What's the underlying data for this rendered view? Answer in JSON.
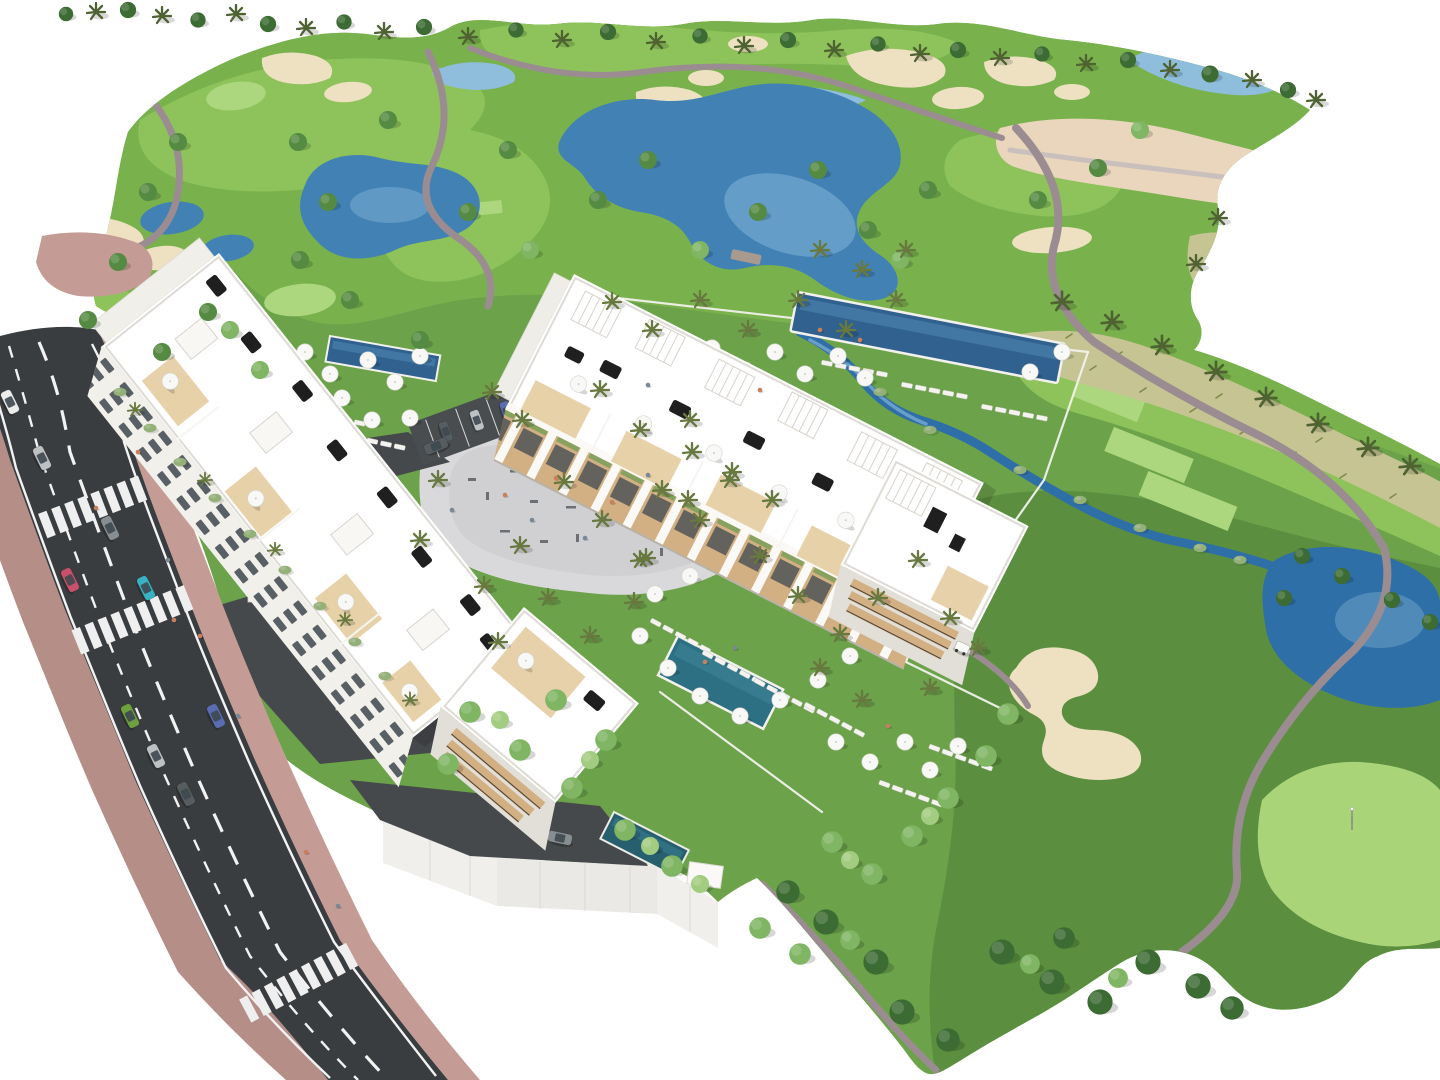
{
  "canvas": {
    "width": 1440,
    "height": 1080
  },
  "scene": {
    "kind": "aerial-3d-architectural-rendering",
    "regions": [
      "golf-course",
      "lakes",
      "sand-bunkers",
      "cart-paths",
      "apartment-buildings",
      "resort-gardens",
      "swimming-pools",
      "playground-plaza",
      "street",
      "parked-cars"
    ]
  },
  "palette": {
    "bg": "#FFFFFF",
    "base": "#6CA24A",
    "fairway": "#79B24D",
    "fairwayLight": "#8DC35A",
    "fairwayPale": "#ACD77E",
    "greenLight": "#A9D478",
    "lawnDark": "#5B8F3F",
    "dryGrass": "#C6C492",
    "sand": "#EDE1C1",
    "sandWaste": "#E9D6BC",
    "water": "#4281B4",
    "waterDeep": "#2F6FA7",
    "waterLight": "#8FBEDD",
    "poolBlue": "#30618F",
    "pool": "#2D7083",
    "road": "#3A3D3F",
    "roadLine": "#F2F2F2",
    "sidewalk": "#C59C95",
    "sidewalkShade": "#B58E88",
    "path": "#9A8C90",
    "pathLight": "#C9BFBC",
    "plaza": "#D9D9DB",
    "plazaEdge": "#C9C9CC",
    "white": "#FFFFFF",
    "facade": "#F2F0EB",
    "facadeShade": "#E2DFD8",
    "wood": "#D2B083",
    "glass": "#3E4850",
    "black": "#1F1F1F",
    "umbrella": "#F8F8F6",
    "tree": "#558A42",
    "treeDark": "#3C6B33",
    "treeLight": "#7FB563",
    "treeLighter": "#A2CC80",
    "palm": "#68793F",
    "palmDark": "#4F6232",
    "shrub": "#93B079",
    "equipment": "#6B7075",
    "carRed": "#C8506C",
    "carTeal": "#38B2C3",
    "carGreen": "#6FA03F",
    "carSilver": "#BCC1C4",
    "carGray": "#878D90",
    "carDark": "#565C5F",
    "carBlue": "#5A6DB4",
    "carWhite": "#ECECEA",
    "person": "#C97F5B",
    "personAlt": "#7A8894"
  }
}
